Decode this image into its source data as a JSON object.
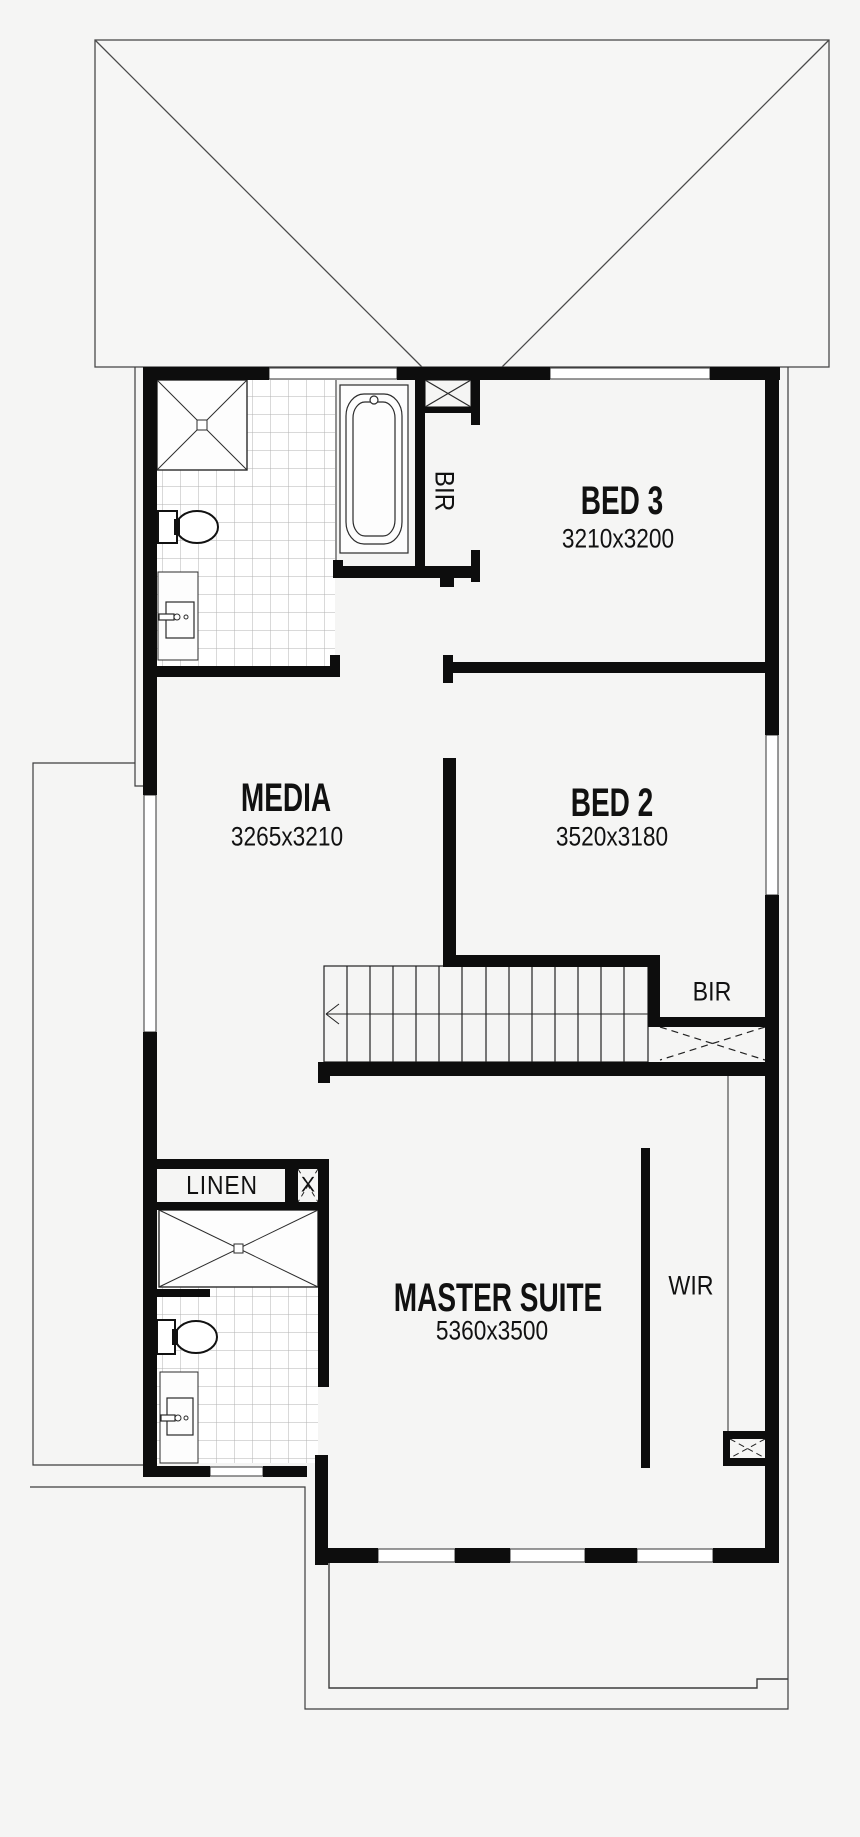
{
  "colors": {
    "wall": "#0d0d0d",
    "thin_line": "#444444",
    "tile_line": "#b3b3b3",
    "fixture_fill": "#ffffff",
    "background": "#f5f5f4"
  },
  "rooms": [
    {
      "id": "bed3",
      "label": "BED 3",
      "dimensions": "3210x3200"
    },
    {
      "id": "bed2",
      "label": "BED 2",
      "dimensions": "3520x3180"
    },
    {
      "id": "media",
      "label": "MEDIA",
      "dimensions": "3265x3210"
    },
    {
      "id": "master",
      "label": "MASTER SUITE",
      "dimensions": "5360x3500"
    }
  ],
  "closets": {
    "bir_bathroom": "BIR",
    "bir_landing": "BIR",
    "wir": "WIR",
    "linen": "LINEN",
    "linen_box_marker": "X"
  }
}
